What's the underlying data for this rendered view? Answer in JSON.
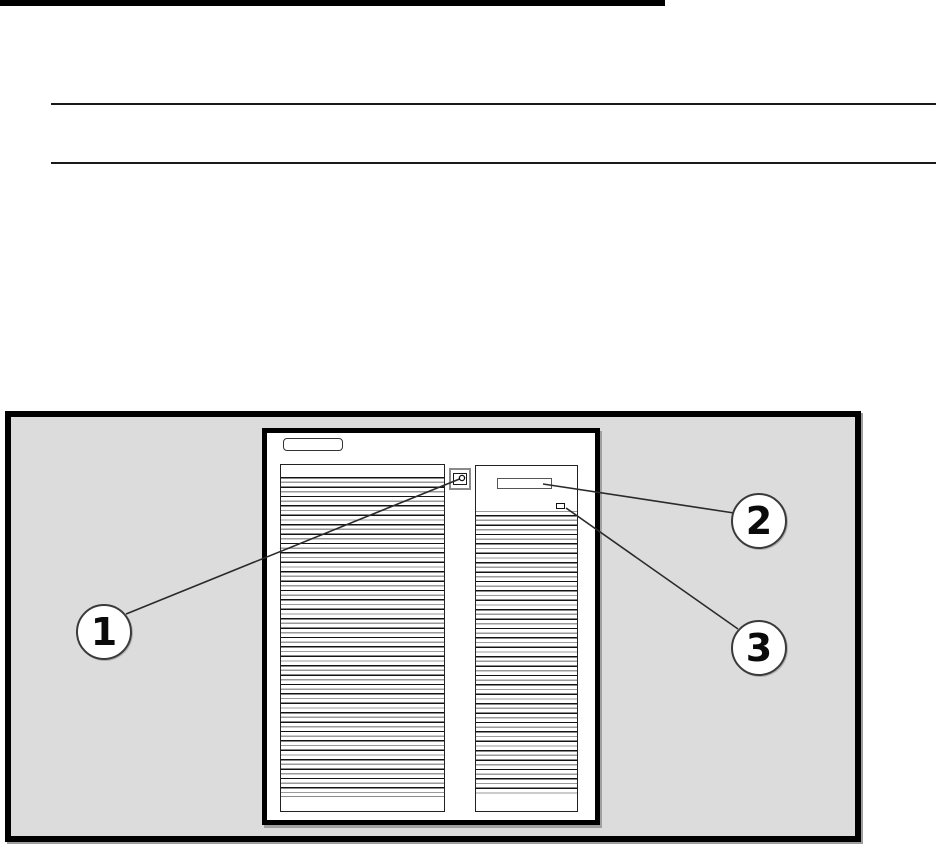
{
  "page": {
    "background_color": "#ffffff",
    "heading_underline_color": "#000000",
    "section_rule_color": "#1a1a1a"
  },
  "figure": {
    "frame_background": "#dcdcdc",
    "frame_border_color": "#000000",
    "tower": {
      "face_color": "#ffffff",
      "outline_color": "#000000",
      "vent_stripe_dark": "#141414",
      "vent_stripe_light": "#9a9a9a",
      "icons": [
        {
          "name": "power-button-icon"
        },
        {
          "name": "media-bay-slot"
        },
        {
          "name": "status-indicator-square"
        }
      ]
    },
    "callouts": [
      {
        "number": "1"
      },
      {
        "number": "2"
      },
      {
        "number": "3"
      }
    ]
  }
}
